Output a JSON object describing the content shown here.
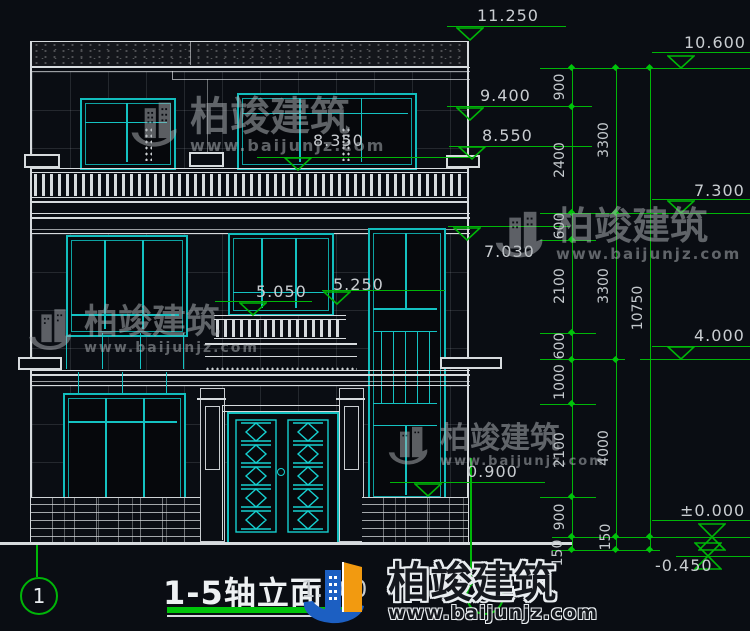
{
  "drawing": {
    "title": "1-5轴立面",
    "scale": "1:100",
    "axis_start": "1",
    "axis_end": "5"
  },
  "levels": {
    "p11_250": "11.250",
    "p10_600": "10.600",
    "p9_400": "9.400",
    "p8_550": "8.550",
    "p8_350": "8.350",
    "p7_300": "7.300",
    "p7_030": "7.030",
    "p5_250": "5.250",
    "p5_050": "5.050",
    "p4_000": "4.000",
    "p0_900": "0.900",
    "p0_000": "±0.000",
    "pm0_450": "-0.450"
  },
  "dims": {
    "chain_a": [
      "900",
      "2400",
      "600",
      "2100",
      "600",
      "1000",
      "2100",
      "900",
      "150"
    ],
    "chain_b": [
      "3300",
      "3300",
      "4000",
      "150"
    ],
    "total": "10750"
  },
  "watermark": {
    "brand": "柏竣建筑",
    "url": "www.baijunjz.com"
  }
}
